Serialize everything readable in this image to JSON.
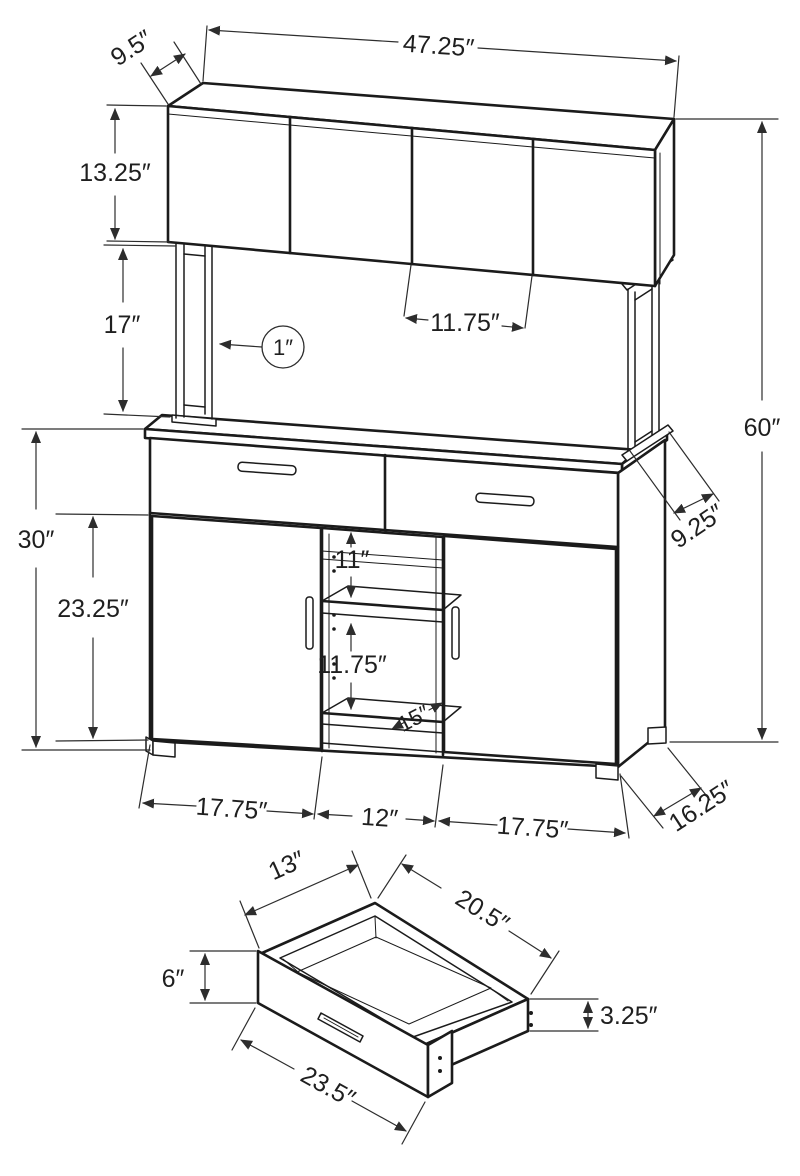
{
  "colors": {
    "background": "#ffffff",
    "furniture_line": "#1b1b1b",
    "dimension_line": "#2d2d2d",
    "text": "#1f1f1f"
  },
  "dims": {
    "hutch_depth": "9.5″",
    "overall_width": "47.25″",
    "hutch_height": "13.25″",
    "riser_height": "17″",
    "hutch_opening_width": "11.75″",
    "frame_thickness": "1″",
    "overall_height": "60″",
    "base_height": "30″",
    "door_height": "23.25″",
    "upper_opening_height": "11″",
    "lower_opening_height": "11.75″",
    "shelf_depth": "15″",
    "riser_depth": "9.25″",
    "left_section_width": "17.75″",
    "center_section_width": "12″",
    "right_section_width": "17.75″",
    "base_depth": "16.25″"
  },
  "drawer_dims": {
    "interior_depth": "13″",
    "interior_width": "20.5″",
    "front_height": "6″",
    "box_height": "3.25″",
    "front_width": "23.5″"
  }
}
